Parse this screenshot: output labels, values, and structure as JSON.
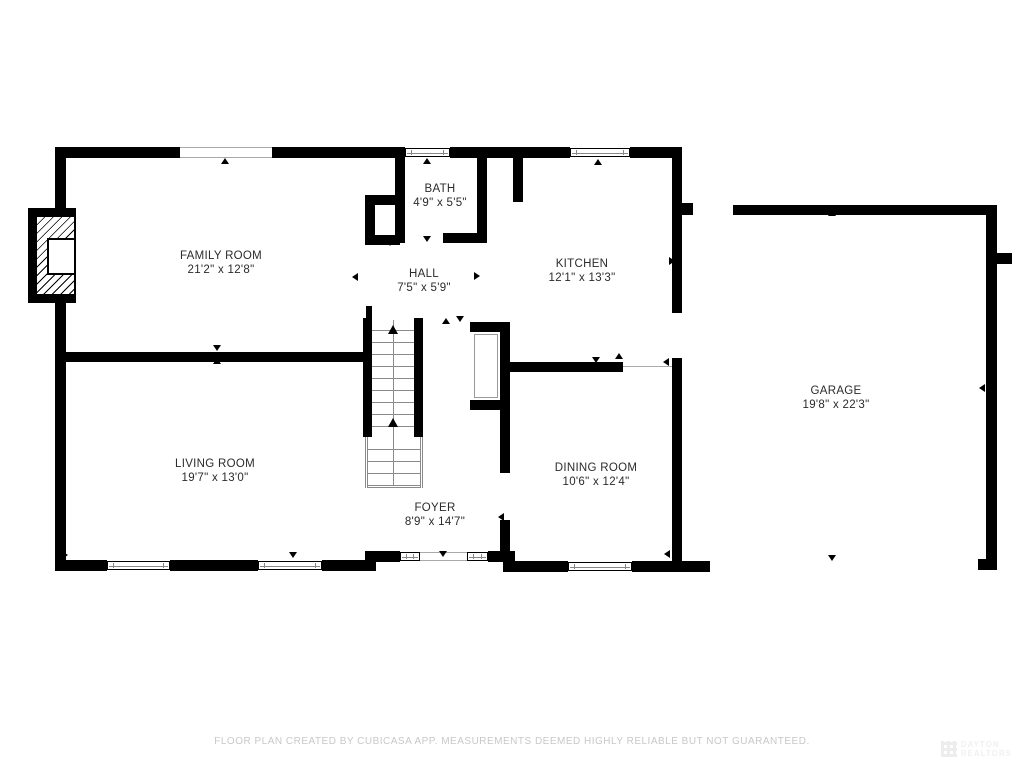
{
  "colors": {
    "wall": "#000000",
    "label": "#2b2b2b",
    "muted_line": "#8a8a8a",
    "footer_text": "#c8c8c8",
    "watermark_text": "#f0f0f0",
    "background": "#ffffff"
  },
  "footer": {
    "disclaimer": "FLOOR PLAN CREATED BY CUBICASA APP. MEASUREMENTS DEEMED HIGHLY RELIABLE BUT NOT GUARANTEED."
  },
  "watermark": {
    "line1": "DAYTON",
    "line2": "REALTORS"
  },
  "rooms": [
    {
      "id": "family-room",
      "name": "FAMILY ROOM",
      "dims": "21'2\" x 12'8\"",
      "cx": 221,
      "cy": 263
    },
    {
      "id": "bath",
      "name": "BATH",
      "dims": "4'9\" x 5'5\"",
      "cx": 440,
      "cy": 196
    },
    {
      "id": "hall",
      "name": "HALL",
      "dims": "7'5\" x 5'9\"",
      "cx": 424,
      "cy": 281
    },
    {
      "id": "kitchen",
      "name": "KITCHEN",
      "dims": "12'1\" x 13'3\"",
      "cx": 582,
      "cy": 271
    },
    {
      "id": "living-room",
      "name": "LIVING ROOM",
      "dims": "19'7\" x 13'0\"",
      "cx": 215,
      "cy": 471
    },
    {
      "id": "foyer",
      "name": "FOYER",
      "dims": "8'9\" x 14'7\"",
      "cx": 435,
      "cy": 515
    },
    {
      "id": "dining-room",
      "name": "DINING ROOM",
      "dims": "10'6\" x 12'4\"",
      "cx": 596,
      "cy": 475
    },
    {
      "id": "garage",
      "name": "GARAGE",
      "dims": "19'8\" x 22'3\"",
      "cx": 836,
      "cy": 398
    }
  ],
  "walls": [
    [
      55,
      147,
      125,
      11
    ],
    [
      272,
      147,
      133,
      11
    ],
    [
      450,
      147,
      120,
      11
    ],
    [
      630,
      147,
      52,
      11
    ],
    [
      55,
      147,
      11,
      61
    ],
    [
      55,
      303,
      11,
      268
    ],
    [
      55,
      560,
      52,
      11
    ],
    [
      170,
      560,
      88,
      11
    ],
    [
      322,
      560,
      43,
      11
    ],
    [
      365,
      551,
      11,
      20
    ],
    [
      376,
      551,
      24,
      11
    ],
    [
      488,
      551,
      15,
      11
    ],
    [
      503,
      551,
      12,
      21
    ],
    [
      515,
      561,
      53,
      11
    ],
    [
      632,
      561,
      78,
      11
    ],
    [
      672,
      147,
      10,
      166
    ],
    [
      672,
      358,
      10,
      213
    ],
    [
      682,
      203,
      11,
      12
    ],
    [
      55,
      352,
      308,
      10
    ],
    [
      363,
      318,
      9,
      119
    ],
    [
      414,
      318,
      9,
      119
    ],
    [
      366,
      306,
      6,
      12
    ],
    [
      395,
      158,
      10,
      85
    ],
    [
      477,
      158,
      10,
      75
    ],
    [
      443,
      233,
      44,
      10
    ],
    [
      513,
      158,
      10,
      44
    ],
    [
      365,
      195,
      30,
      10
    ],
    [
      365,
      195,
      10,
      50
    ],
    [
      365,
      235,
      35,
      10
    ],
    [
      470,
      322,
      40,
      10
    ],
    [
      500,
      322,
      10,
      88
    ],
    [
      470,
      400,
      40,
      10
    ],
    [
      500,
      410,
      10,
      63
    ],
    [
      500,
      520,
      10,
      41
    ],
    [
      510,
      362,
      113,
      10
    ],
    [
      733,
      205,
      264,
      10
    ],
    [
      986,
      205,
      11,
      355
    ],
    [
      978,
      559,
      19,
      11
    ],
    [
      997,
      253,
      15,
      11
    ]
  ],
  "windows": [
    {
      "x": 180,
      "y": 147,
      "w": 92,
      "h": 11,
      "style": "plain",
      "name": "family-room-picture-window"
    },
    {
      "x": 405,
      "y": 148,
      "w": 45,
      "h": 9,
      "style": "framed",
      "name": "bath-window"
    },
    {
      "x": 570,
      "y": 148,
      "w": 60,
      "h": 9,
      "style": "framed",
      "name": "kitchen-window"
    },
    {
      "x": 107,
      "y": 561,
      "w": 63,
      "h": 9,
      "style": "framed",
      "name": "living-room-window-1"
    },
    {
      "x": 258,
      "y": 561,
      "w": 64,
      "h": 9,
      "style": "framed",
      "name": "living-room-window-2"
    },
    {
      "x": 400,
      "y": 552,
      "w": 20,
      "h": 9,
      "style": "framed",
      "name": "foyer-sidelight-left"
    },
    {
      "x": 420,
      "y": 552,
      "w": 47,
      "h": 9,
      "style": "plain",
      "name": "front-door-opening"
    },
    {
      "x": 467,
      "y": 552,
      "w": 21,
      "h": 9,
      "style": "framed",
      "name": "foyer-sidelight-right"
    },
    {
      "x": 568,
      "y": 562,
      "w": 64,
      "h": 9,
      "style": "framed",
      "name": "dining-room-window"
    }
  ],
  "thin_lines": [
    [
      623,
      366,
      49,
      1
    ]
  ],
  "thin_rects": [
    [
      474,
      334,
      24,
      64
    ]
  ],
  "markers": [
    [
      225,
      162,
      "up"
    ],
    [
      427,
      162,
      "up"
    ],
    [
      598,
      163,
      "up"
    ],
    [
      62,
      181,
      "right"
    ],
    [
      217,
      349,
      "down"
    ],
    [
      217,
      362,
      "up"
    ],
    [
      427,
      240,
      "down"
    ],
    [
      453,
      237,
      "up"
    ],
    [
      390,
      244,
      "down"
    ],
    [
      356,
      277,
      "left"
    ],
    [
      478,
      276,
      "right"
    ],
    [
      446,
      322,
      "up"
    ],
    [
      460,
      320,
      "down"
    ],
    [
      596,
      361,
      "down"
    ],
    [
      619,
      357,
      "up"
    ],
    [
      502,
      517,
      "left"
    ],
    [
      443,
      555,
      "down"
    ],
    [
      293,
      556,
      "down"
    ],
    [
      66,
      555,
      "right"
    ],
    [
      673,
      261,
      "right"
    ],
    [
      667,
      362,
      "left"
    ],
    [
      832,
      214,
      "up"
    ],
    [
      983,
      388,
      "left"
    ],
    [
      832,
      559,
      "down"
    ],
    [
      668,
      554,
      "left"
    ]
  ],
  "stairs": {
    "upper": {
      "x": 372,
      "w": 42,
      "y0": 330,
      "count": 9,
      "step": 12
    },
    "lower": {
      "x": 368,
      "w": 52,
      "treads": [
        449,
        461,
        473,
        485
      ],
      "railL": 365,
      "railR": 420,
      "y0": 437,
      "h": 51
    },
    "center_line": {
      "x": 393,
      "y0": 320,
      "y1": 486
    },
    "arrows": [
      [
        393,
        325
      ],
      [
        393,
        418
      ]
    ]
  },
  "fireplace": {
    "outer": [
      28,
      208,
      48,
      95
    ],
    "hatch": [
      36,
      216,
      39,
      79
    ],
    "box": [
      47,
      238,
      29,
      37
    ]
  }
}
